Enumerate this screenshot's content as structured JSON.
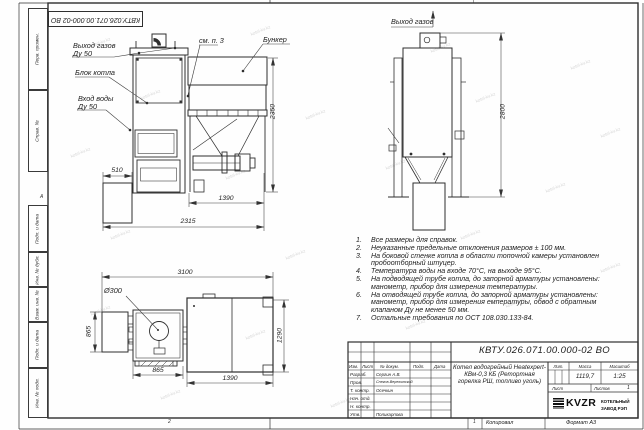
{
  "sheet": {
    "doc_number": "КВТУ.026.071.00.000-02 ВО",
    "watermark": "kotel-kv.kz",
    "zones": {
      "top_1": "1",
      "bottom_2": "2",
      "bottom_1": "1",
      "left_a": "А"
    },
    "footer": {
      "kopiroval": "Копировал",
      "format": "Формат А3"
    }
  },
  "left_stamps": [
    "Перв. примен.",
    "Справ. №",
    "Подп. и дата",
    "Инв. № дубл.",
    "Взам. инв. №",
    "Подп. и дата",
    "Инв. № подл."
  ],
  "front_view": {
    "labels": {
      "gas_out": "Выход газов",
      "gas_out_dn": "Ду 50",
      "boiler_block": "Блок котла",
      "water_in": "Вход воды",
      "water_in_dn": "Ду 50",
      "see_note": "см. п. 3",
      "hopper": "Бункер"
    },
    "dims": {
      "height": "2350",
      "ash_width": "510",
      "feeder": "1390",
      "overall": "2315"
    }
  },
  "side_view": {
    "labels": {
      "gas_out": "Выход газов"
    },
    "dims": {
      "height": "2800"
    }
  },
  "plan_view": {
    "labels": {
      "diameter": "Ø300"
    },
    "dims": {
      "overall_w": "3100",
      "left_d": "865",
      "boiler_w": "865",
      "hopper_w": "1390",
      "hopper_d": "1290"
    }
  },
  "notes": {
    "items": [
      {
        "num": "1.",
        "text": "Все размеры для справок."
      },
      {
        "num": "2.",
        "text": "Неуказанные предельные отклонения размеров ± 100 мм."
      },
      {
        "num": "3.",
        "text": "На боковой стенке котла в области топочной камеры установлен пробоотборный штуцер."
      },
      {
        "num": "4.",
        "text": "Температура воды на входе 70°С, на выходе 95°С."
      },
      {
        "num": "5.",
        "text": "На подводящей трубе котла, до запорной арматуры установлены: манометр, прибор для измерения температуры."
      },
      {
        "num": "6.",
        "text": "На отводящей трубе котла, до запорной арматуры установлены: манометр, прибор для измерения емпературы, обвод с обратным клапаном Ду не менее 50 мм."
      },
      {
        "num": "7.",
        "text": "Остальные требования по ОСТ 108.030.133-84."
      }
    ]
  },
  "title_block": {
    "product": "Котел водогрейный Heatexpert-КВм-0,3 КБ (Ретортная горелка РШ, топливо уголь)",
    "header": {
      "izm": "Изм.",
      "list": "Лист",
      "doc": "№ докум.",
      "podp": "Подп.",
      "data": "Дата"
    },
    "rows": [
      {
        "role": "Разраб.",
        "name": "Сергин А.В."
      },
      {
        "role": "Пров.",
        "name": "Снегов-Вережинский"
      },
      {
        "role": "Т. контр.",
        "name": "Осечкин"
      },
      {
        "role": "Нач. отд.",
        "name": ""
      },
      {
        "role": "Н. контр.",
        "name": ""
      },
      {
        "role": "Утв.",
        "name": "Поликарпова"
      }
    ],
    "lit_label": "Лит.",
    "mass_label": "Масса",
    "scale_label": "Масштаб",
    "mass": "1119,7",
    "scale": "1:25",
    "sheet_label": "Лист",
    "sheets_label": "Листов",
    "sheets_value": "1",
    "logo_text": "KVZR",
    "logo_line1": "КОТЕЛЬНЫЙ",
    "logo_line2": "ЗАВОД РЭП"
  }
}
